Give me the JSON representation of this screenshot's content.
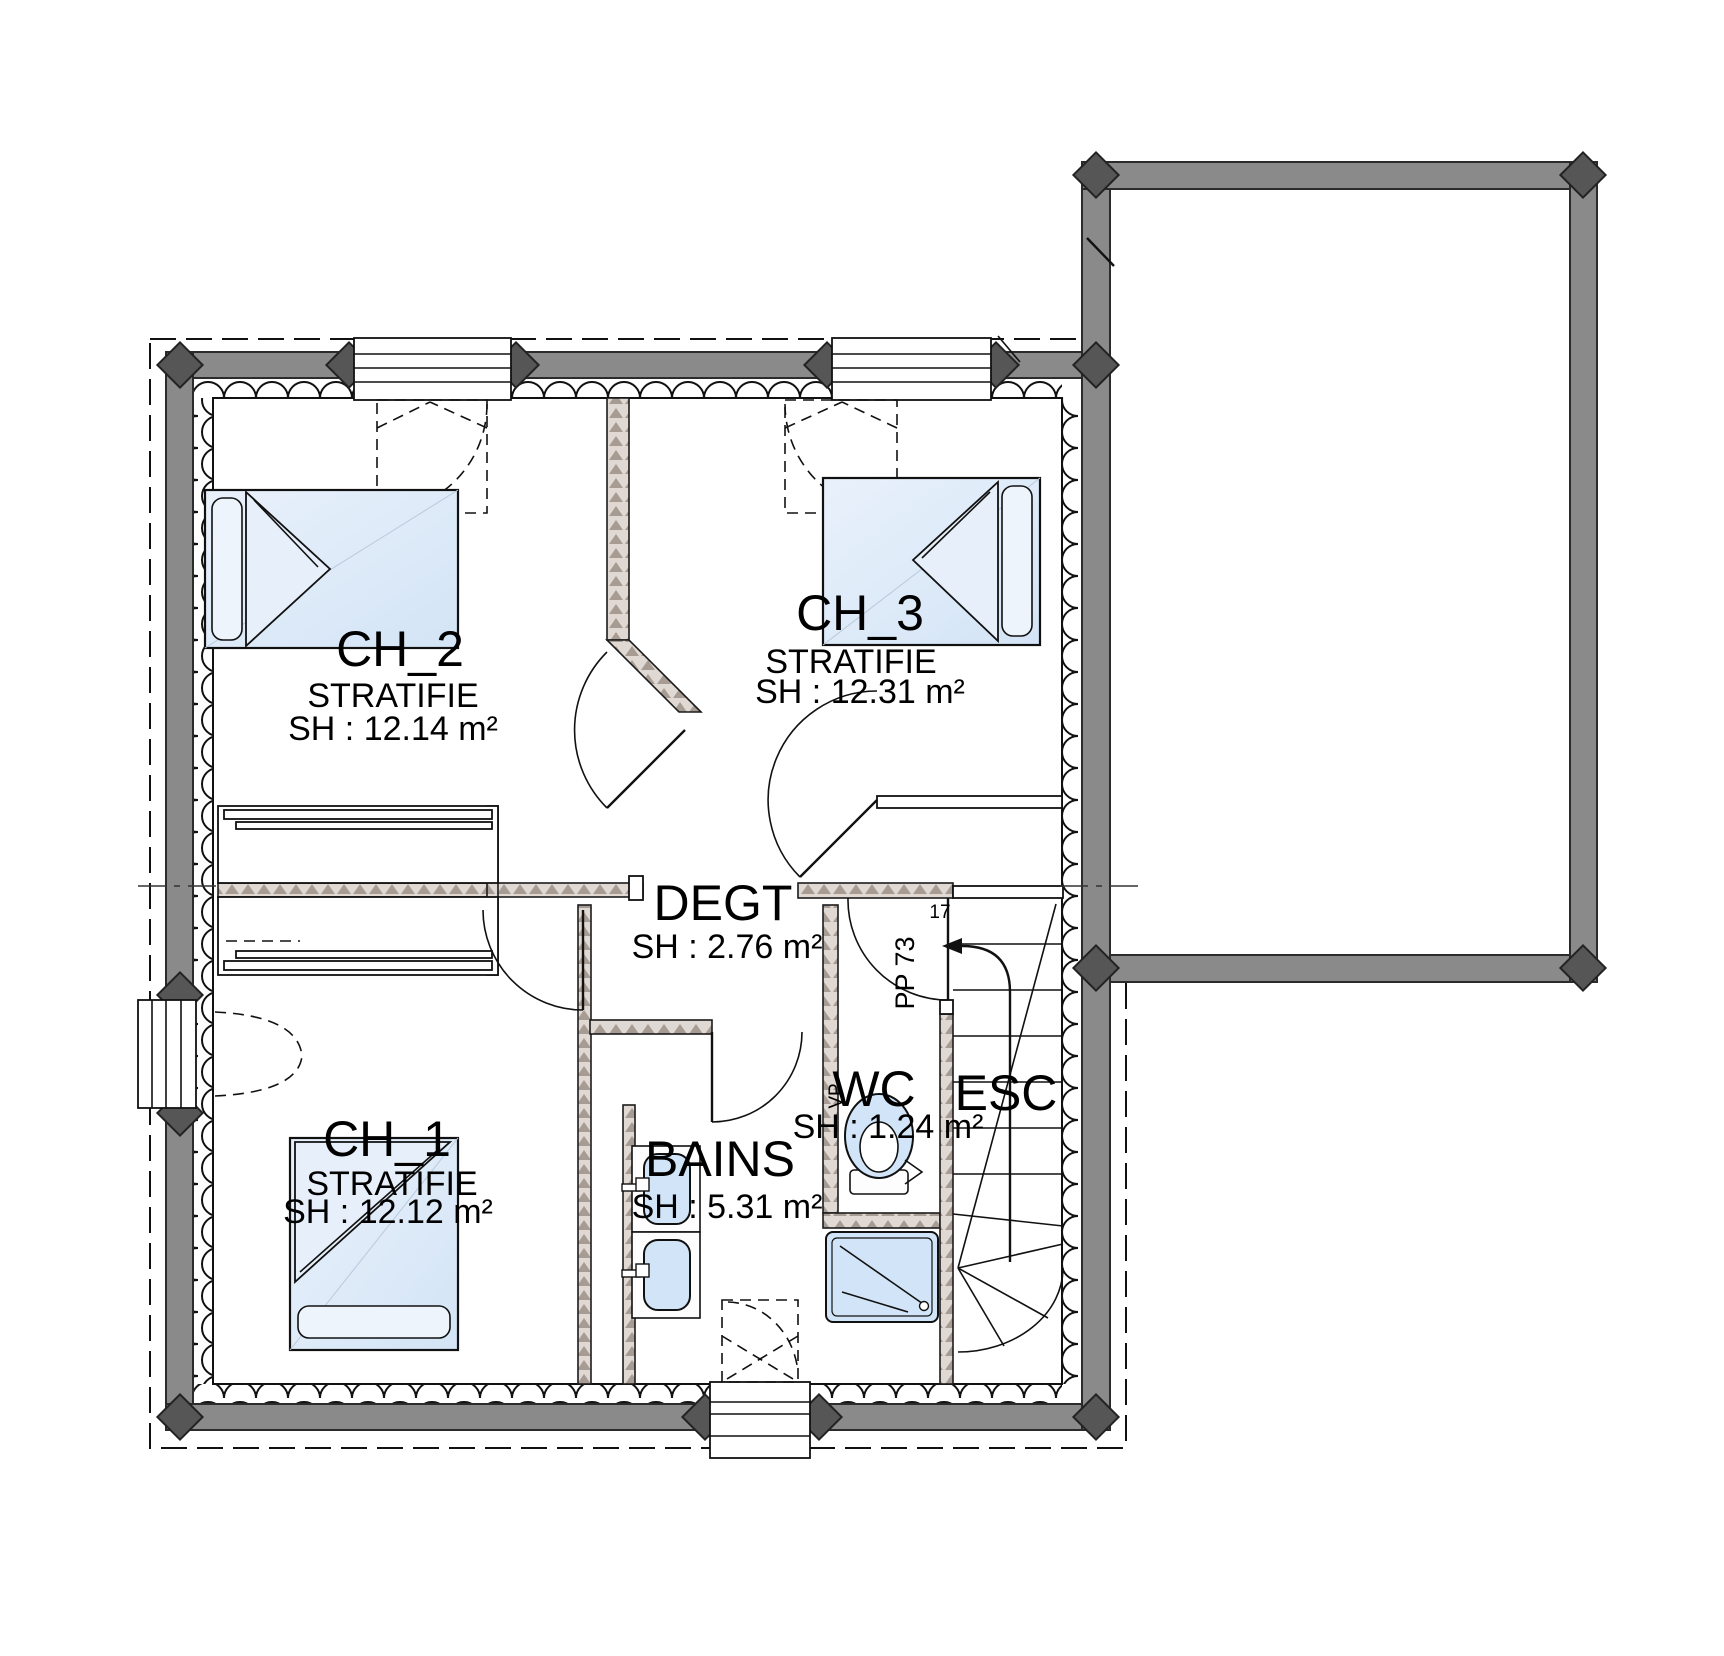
{
  "plan_type": "floor-plan",
  "rooms": [
    {
      "name": "CH_2",
      "floor": "STRATIFIE",
      "area": "SH : 12.14 m²"
    },
    {
      "name": "CH_3",
      "floor": "STRATIFIE",
      "area": "SH : 12.31 m²"
    },
    {
      "name": "DEGT",
      "area": "SH : 2.76 m²"
    },
    {
      "name": "CH_1",
      "floor": "STRATIFIE",
      "area": "SH : 12.12 m²"
    },
    {
      "name": "BAINS",
      "area": "SH : 5.31 m²"
    },
    {
      "name": "WC",
      "area": "SH : 1.24 m²"
    },
    {
      "name": "ESC"
    }
  ],
  "annotations": {
    "door_width_label": "PP 73",
    "stair_step_count": "17",
    "vent_label": "VP"
  },
  "colors": {
    "wall_fill": "#8a8a8a",
    "post_fill": "#565656",
    "partition_base": "#e0d8d2",
    "partition_hatch": "#a79c93",
    "fixture_fill": "#d2e5f8",
    "bed_fill": "#dcebfa",
    "line": "#111111",
    "background": "#ffffff"
  }
}
